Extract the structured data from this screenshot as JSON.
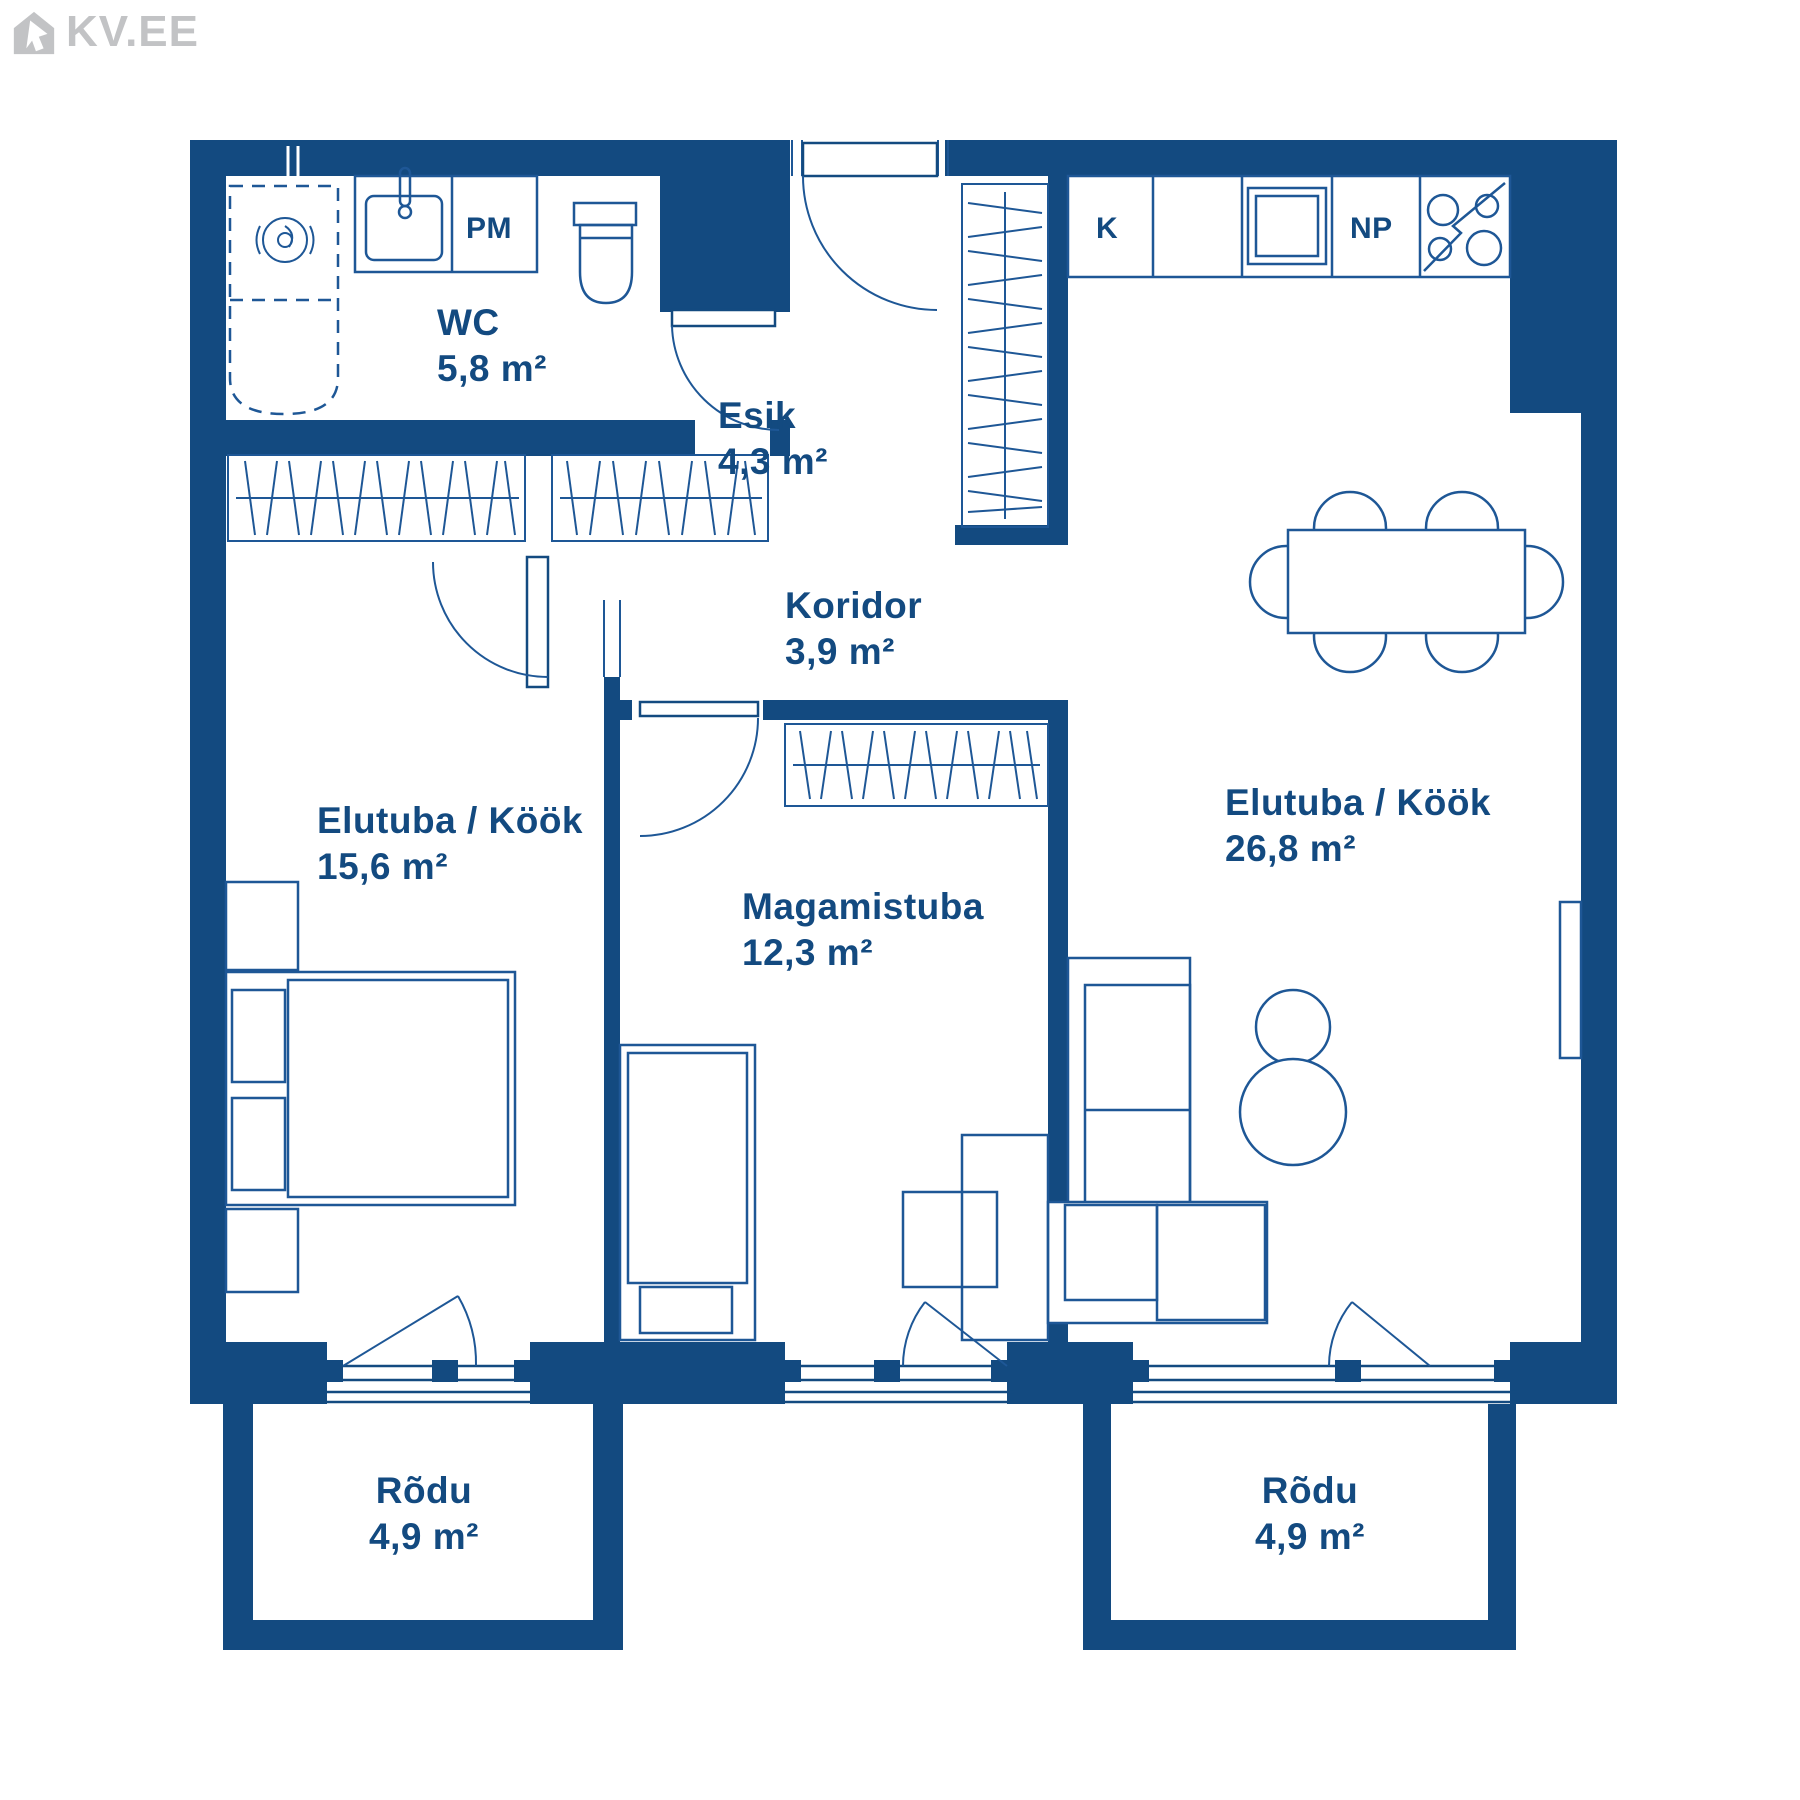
{
  "logo": {
    "text": "KV.EE"
  },
  "colors": {
    "wall_navy": "#134A80",
    "furniture_line": "#1E5796",
    "logo_gray": "#C2C3C5",
    "background": "#FFFFFF"
  },
  "rooms": {
    "wc": {
      "name": "WC",
      "area": "5,8 m²"
    },
    "esik": {
      "name": "Esik",
      "area": "4,3 m²"
    },
    "koridor": {
      "name": "Koridor",
      "area": "3,9 m²"
    },
    "elutuba_vasak": {
      "name": "Elutuba / Köök",
      "area": "15,6 m²"
    },
    "magamistuba": {
      "name": "Magamistuba",
      "area": "12,3 m²"
    },
    "elutuba_parem": {
      "name": "Elutuba / Köök",
      "area": "26,8 m²"
    },
    "rodu_vasak": {
      "name": "Rõdu",
      "area": "4,9 m²"
    },
    "rodu_parem": {
      "name": "Rõdu",
      "area": "4,9 m²"
    }
  },
  "appliance_labels": {
    "washing_machine": "PM",
    "fridge": "K",
    "dishwasher": "NP"
  }
}
